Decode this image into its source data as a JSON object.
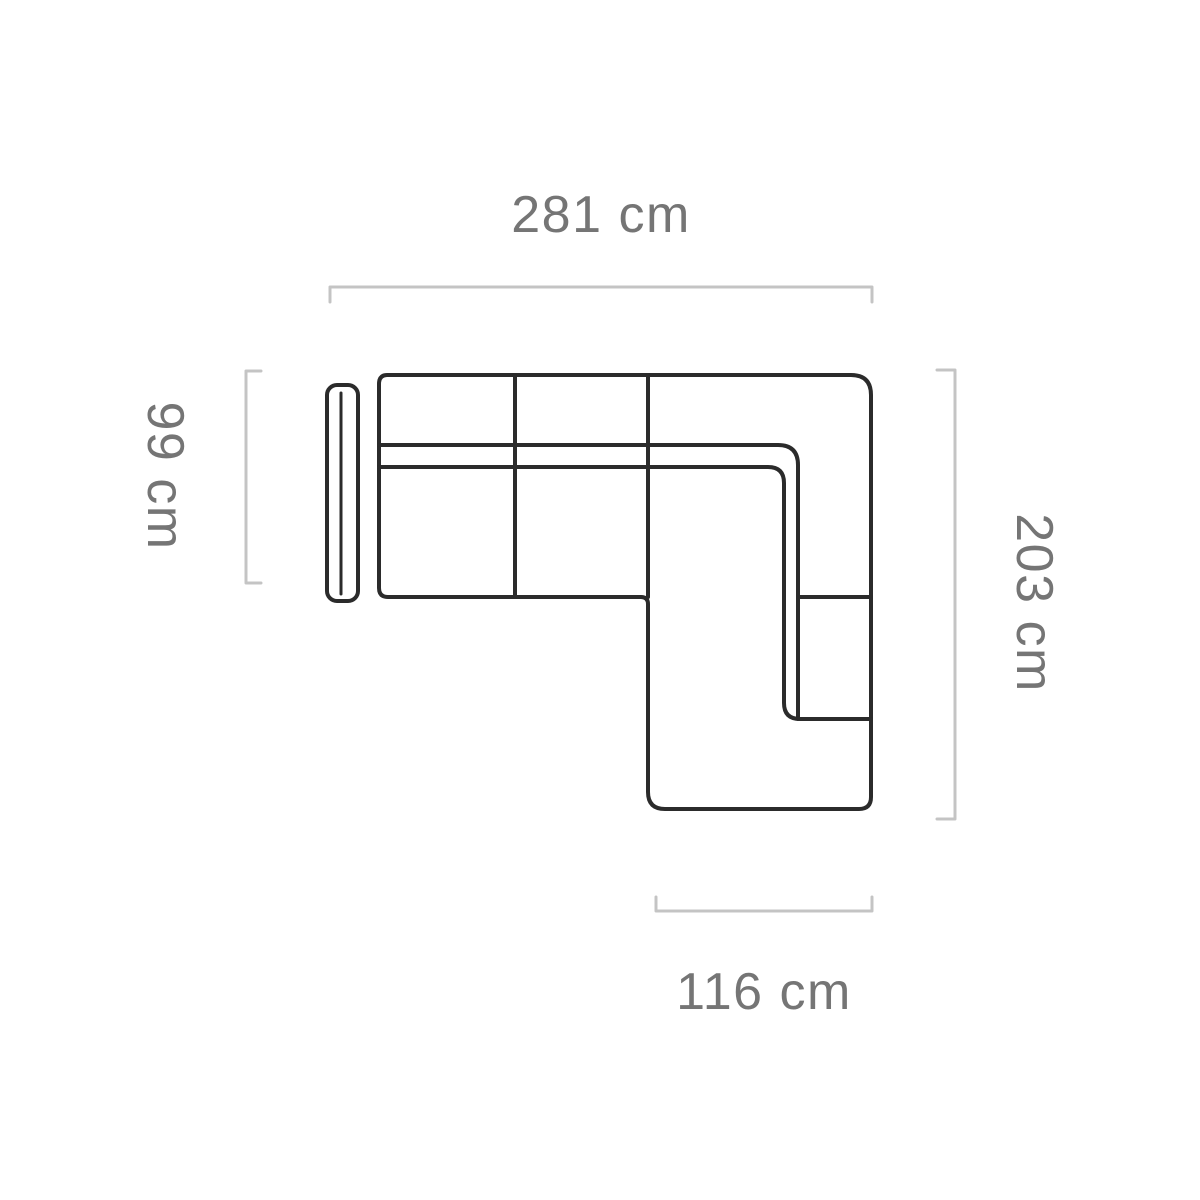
{
  "diagram": {
    "title": "corner-sofa-top-view-dimension-diagram",
    "background_color": "#ffffff",
    "outline_color": "#2b2b2b",
    "dimension_line_color": "#c4c4c4",
    "label_color": "#757575",
    "dimensions": {
      "width": {
        "label": "281 cm",
        "value_cm": 281,
        "side": "top"
      },
      "depth": {
        "label": "99 cm",
        "value_cm": 99,
        "side": "left"
      },
      "length": {
        "label": "203 cm",
        "value_cm": 203,
        "side": "right"
      },
      "chaise_width": {
        "label": "116 cm",
        "value_cm": 116,
        "side": "bottom"
      }
    }
  }
}
